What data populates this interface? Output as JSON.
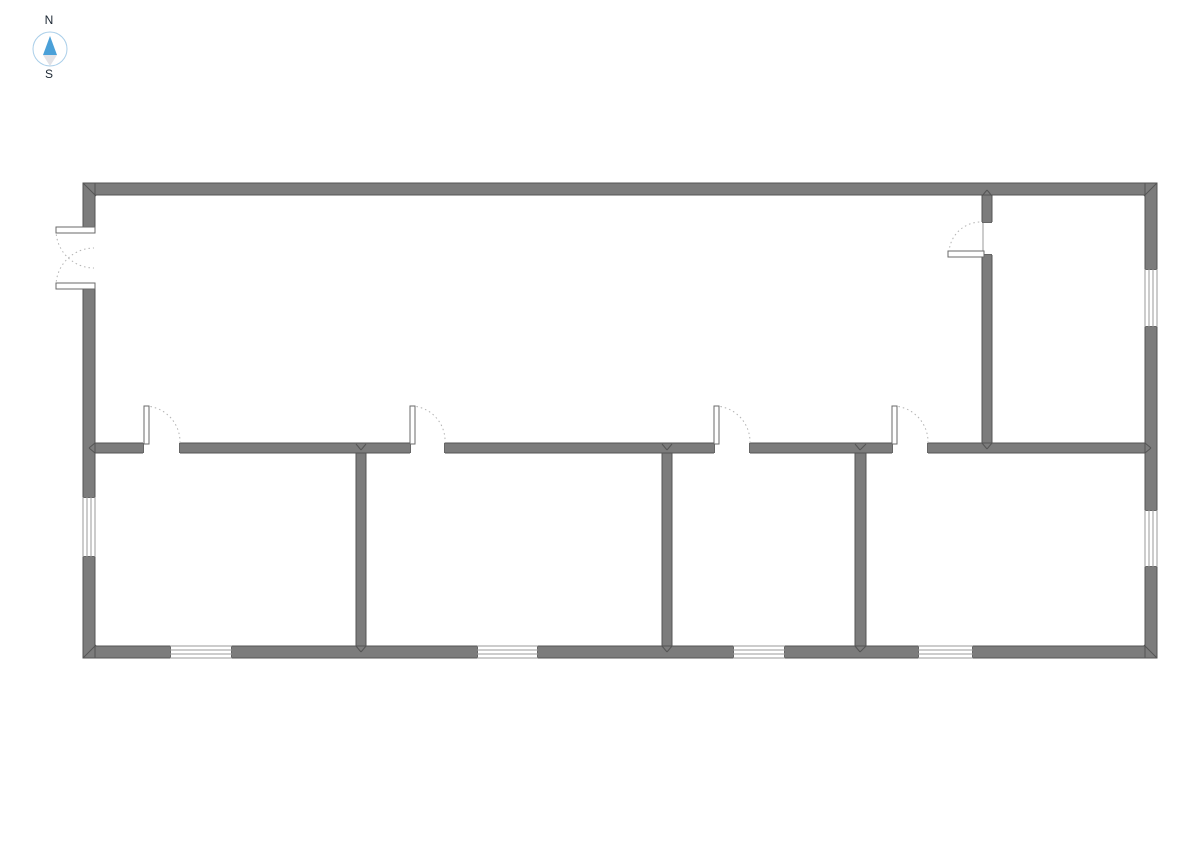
{
  "compass": {
    "north_label": "N",
    "south_label": "S",
    "circle_color": "#a9cee9",
    "needle_north_color": "#4aa0d8",
    "needle_south_color": "#e2e2e6",
    "label_color": "#1c2733"
  },
  "floorplan": {
    "colors": {
      "bg": "#ffffff",
      "wall_fill": "#7c7c7c",
      "wall_edge": "#555555",
      "cap": "#666666",
      "window_line": "#9a9a9a",
      "door_leaf": "#6a6a6a",
      "door_arc": "#b3b3b3"
    },
    "walls": [
      {
        "name": "wall-exterior-top",
        "x": 83,
        "y": 183,
        "w": 1074,
        "h": 12
      },
      {
        "name": "wall-exterior-bottom",
        "x": 83,
        "y": 646,
        "w": 1074,
        "h": 12
      },
      {
        "name": "wall-exterior-left",
        "x": 83,
        "y": 183,
        "w": 12,
        "h": 475
      },
      {
        "name": "wall-exterior-right",
        "x": 1145,
        "y": 183,
        "w": 12,
        "h": 475
      },
      {
        "name": "wall-interior-horizontal",
        "x": 95,
        "y": 443,
        "w": 1050,
        "h": 10
      },
      {
        "name": "wall-interior-room1-room2",
        "x": 356,
        "y": 453,
        "w": 10,
        "h": 193
      },
      {
        "name": "wall-interior-room2-room3",
        "x": 662,
        "y": 453,
        "w": 10,
        "h": 193
      },
      {
        "name": "wall-interior-room3-room4",
        "x": 855,
        "y": 453,
        "w": 11,
        "h": 193
      },
      {
        "name": "wall-interior-top-right-room",
        "x": 982,
        "y": 195,
        "w": 10,
        "h": 248
      }
    ],
    "openings": [
      {
        "name": "entry-door-opening",
        "x": 83,
        "y": 227,
        "w": 12,
        "h": 62,
        "dir": "v"
      },
      {
        "name": "door-opening-room1",
        "x": 143,
        "y": 443,
        "w": 37,
        "h": 10,
        "dir": "h"
      },
      {
        "name": "door-opening-room2",
        "x": 410,
        "y": 443,
        "w": 35,
        "h": 10,
        "dir": "h"
      },
      {
        "name": "door-opening-room3",
        "x": 714,
        "y": 443,
        "w": 36,
        "h": 10,
        "dir": "h"
      },
      {
        "name": "door-opening-room4",
        "x": 892,
        "y": 443,
        "w": 36,
        "h": 10,
        "dir": "h"
      },
      {
        "name": "door-opening-top-right-room",
        "x": 982,
        "y": 222,
        "w": 10,
        "h": 33,
        "dir": "v"
      }
    ],
    "windows": [
      {
        "name": "window-left-room1",
        "x": 83,
        "y": 497,
        "w": 12,
        "h": 60,
        "dir": "v"
      },
      {
        "name": "window-right-top-right-room",
        "x": 1145,
        "y": 269,
        "w": 12,
        "h": 58,
        "dir": "v"
      },
      {
        "name": "window-right-room4",
        "x": 1145,
        "y": 510,
        "w": 12,
        "h": 57,
        "dir": "v"
      },
      {
        "name": "window-bottom-room1",
        "x": 170,
        "y": 646,
        "w": 62,
        "h": 12,
        "dir": "h"
      },
      {
        "name": "window-bottom-room2",
        "x": 477,
        "y": 646,
        "w": 61,
        "h": 12,
        "dir": "h"
      },
      {
        "name": "window-bottom-room3",
        "x": 733,
        "y": 646,
        "w": 52,
        "h": 12,
        "dir": "h"
      },
      {
        "name": "window-bottom-room4",
        "x": 918,
        "y": 646,
        "w": 55,
        "h": 12,
        "dir": "h"
      }
    ],
    "doors": [
      {
        "name": "entry-double-door-leaf-top",
        "leaf": {
          "x": 56,
          "y": 227,
          "w": 39,
          "h": 6
        },
        "arc": {
          "x1": 56,
          "y1": 230,
          "x2": 94,
          "y2": 268,
          "r": 38,
          "sweep": 0
        }
      },
      {
        "name": "entry-double-door-leaf-bottom",
        "leaf": {
          "x": 56,
          "y": 283,
          "w": 39,
          "h": 6
        },
        "arc": {
          "x1": 56,
          "y1": 286,
          "x2": 94,
          "y2": 248,
          "r": 38,
          "sweep": 1
        }
      },
      {
        "name": "door-room1",
        "leaf": {
          "x": 144,
          "y": 406,
          "w": 5,
          "h": 38
        },
        "arc": {
          "x1": 146,
          "y1": 406,
          "x2": 180,
          "y2": 443,
          "r": 36,
          "sweep": 1
        }
      },
      {
        "name": "door-room2",
        "leaf": {
          "x": 410,
          "y": 406,
          "w": 5,
          "h": 38
        },
        "arc": {
          "x1": 412,
          "y1": 406,
          "x2": 445,
          "y2": 443,
          "r": 35,
          "sweep": 1
        }
      },
      {
        "name": "door-room3",
        "leaf": {
          "x": 714,
          "y": 406,
          "w": 5,
          "h": 38
        },
        "arc": {
          "x1": 716,
          "y1": 406,
          "x2": 750,
          "y2": 443,
          "r": 36,
          "sweep": 1
        }
      },
      {
        "name": "door-room4",
        "leaf": {
          "x": 892,
          "y": 406,
          "w": 5,
          "h": 38
        },
        "arc": {
          "x1": 894,
          "y1": 406,
          "x2": 928,
          "y2": 443,
          "r": 36,
          "sweep": 1
        }
      },
      {
        "name": "door-top-right-room",
        "leaf": {
          "x": 948,
          "y": 251,
          "w": 36,
          "h": 6
        },
        "arc": {
          "x1": 949,
          "y1": 252,
          "x2": 982,
          "y2": 222,
          "r": 32,
          "sweep": 1
        },
        "jamb": [
          983,
          223,
          983,
          251
        ]
      }
    ],
    "miters": [
      [
        83,
        183,
        96,
        196
      ],
      [
        1157,
        183,
        1144,
        196
      ],
      [
        83,
        658,
        96,
        645
      ],
      [
        1157,
        658,
        1144,
        645
      ],
      [
        356,
        444,
        361,
        450
      ],
      [
        366,
        444,
        361,
        450
      ],
      [
        356,
        646,
        361,
        652
      ],
      [
        366,
        646,
        361,
        652
      ],
      [
        662,
        444,
        667,
        450
      ],
      [
        672,
        444,
        667,
        450
      ],
      [
        662,
        646,
        667,
        652
      ],
      [
        672,
        646,
        667,
        652
      ],
      [
        855,
        444,
        860,
        450
      ],
      [
        866,
        444,
        860,
        450
      ],
      [
        855,
        646,
        860,
        652
      ],
      [
        866,
        646,
        860,
        652
      ],
      [
        982,
        196,
        987,
        190
      ],
      [
        992,
        196,
        987,
        190
      ],
      [
        982,
        443,
        987,
        449
      ],
      [
        992,
        443,
        987,
        449
      ],
      [
        95,
        443,
        89,
        448
      ],
      [
        95,
        453,
        89,
        448
      ],
      [
        1145,
        443,
        1151,
        448
      ],
      [
        1145,
        453,
        1151,
        448
      ]
    ]
  }
}
